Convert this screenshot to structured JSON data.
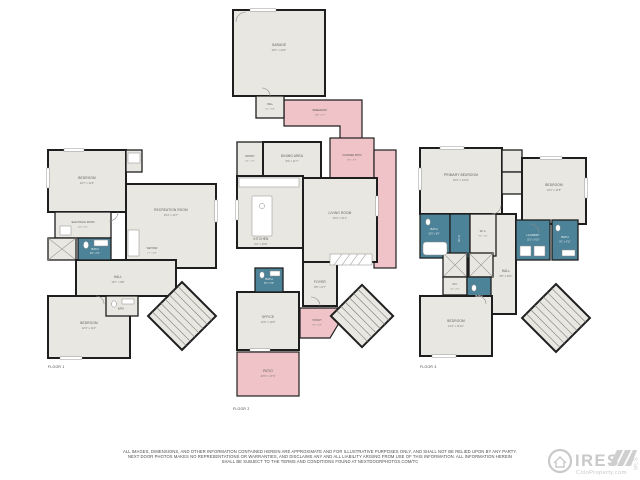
{
  "page": {
    "background": "#ffffff"
  },
  "palette": {
    "wall": "#1e1e1e",
    "room_fill": "#e9e7e1",
    "outdoor_pink": "#efc3c7",
    "bath_teal": "#4d8398",
    "label_gray": "#5a5a55",
    "logo_gray": "#c9c9c9"
  },
  "floors": [
    {
      "label": "FLOOR 1",
      "rooms": [
        {
          "name": "BEDROOM",
          "dims": "12'7\" x 11'6\""
        },
        {
          "name": "RECREATION ROOM",
          "dims": "19'4\" x 14'7\""
        },
        {
          "name": "WET BAR",
          "dims": "7'7\" x 6'9\""
        },
        {
          "name": "ELECTRICAL ROOM",
          "dims": "11'4\" x 6'1\""
        },
        {
          "name": "BATH",
          "dims": "8'0\" x 5'1\""
        },
        {
          "name": "HALL",
          "dims": "15'7\" x 9'8\""
        },
        {
          "name": "BATH",
          "dims": "7'3\" x 3'0\""
        },
        {
          "name": "BEDROOM",
          "dims": "12'4\" x 11'0\""
        }
      ]
    },
    {
      "label": "FLOOR 2",
      "rooms": [
        {
          "name": "GARAGE",
          "dims": "20'1\" x 20'4\""
        },
        {
          "name": "HALL",
          "dims": "5'1\" x 5'8\""
        },
        {
          "name": "BREEZEWAY",
          "dims": "16'8\" x 5'7\""
        },
        {
          "name": "PANTRY",
          "dims": "4'1\" x 7'5\""
        },
        {
          "name": "DINING AREA",
          "dims": "9'9\" x 11'7\""
        },
        {
          "name": "COVERED PATIO",
          "dims": "9'4\" x 8'7\""
        },
        {
          "name": "KITCHEN",
          "dims": "9'2\" x 16'6\""
        },
        {
          "name": "LIVING ROOM",
          "dims": "16'4\" x 21'1\""
        },
        {
          "name": "BATH",
          "dims": "5'0\" x 5'6\""
        },
        {
          "name": "FOYER",
          "dims": "8'9\" x 6'7\""
        },
        {
          "name": "OFFICE",
          "dims": "12'0\" x 10'9\""
        },
        {
          "name": "PORCH",
          "dims": "9'0\" x 5'9\""
        },
        {
          "name": "PATIO",
          "dims": "20'6\" x 17'0\""
        }
      ]
    },
    {
      "label": "FLOOR 3",
      "rooms": [
        {
          "name": "PRIMARY BEDROOM",
          "dims": "15'4\" x 13'11\""
        },
        {
          "name": "BEDROOM",
          "dims": "12'1\" x 11'5\""
        },
        {
          "name": "BATH",
          "dims": "10'5\" x 9'6\""
        },
        {
          "name": "W.I.C.",
          "dims": "10'0\" x 4'11\""
        },
        {
          "name": "W.I.C.",
          "dims": "9'0\" x 5'2\""
        },
        {
          "name": "LAUNDRY",
          "dims": "10'1\" x 6'10\""
        },
        {
          "name": "BATH",
          "dims": "8'1\" x 4'11\""
        },
        {
          "name": "HALL",
          "dims": "9'5\" x 23'1\""
        },
        {
          "name": "BATH",
          "dims": "8'1\" x 5'0\""
        },
        {
          "name": "W.C.",
          "dims": "4'1\" x 4'0\""
        },
        {
          "name": "BEDROOM",
          "dims": "14'2\" x 11'10\""
        }
      ]
    }
  ],
  "disclaimer": {
    "line1": "ALL IMAGES, DIMENSIONS, AND OTHER INFORMATION CONTAINED HEREIN ARE APPROXIMATE AND FOR ILLUSTRATIVE PURPOSES ONLY, AND SHALL NOT BE RELIED UPON BY ANY PARTY.",
    "line2": "NEXT DOOR PHOTOS MAKES NO REPRESENTATIONS OR WARRANTIES, AND DISCLAIMS ANY AND ALL LIABILITY ARISING FROM USE OF THIS INFORMATION. ALL INFORMATION HEREIN",
    "line3": "SHALL BE SUBJECT TO THE TERMS AND CONDITIONS FOUND AT NEXTDOORPHOTOS.COM/TC"
  },
  "logo": {
    "brand": "IRES",
    "site": "ColoProperty.com",
    "mls": "MLS"
  }
}
